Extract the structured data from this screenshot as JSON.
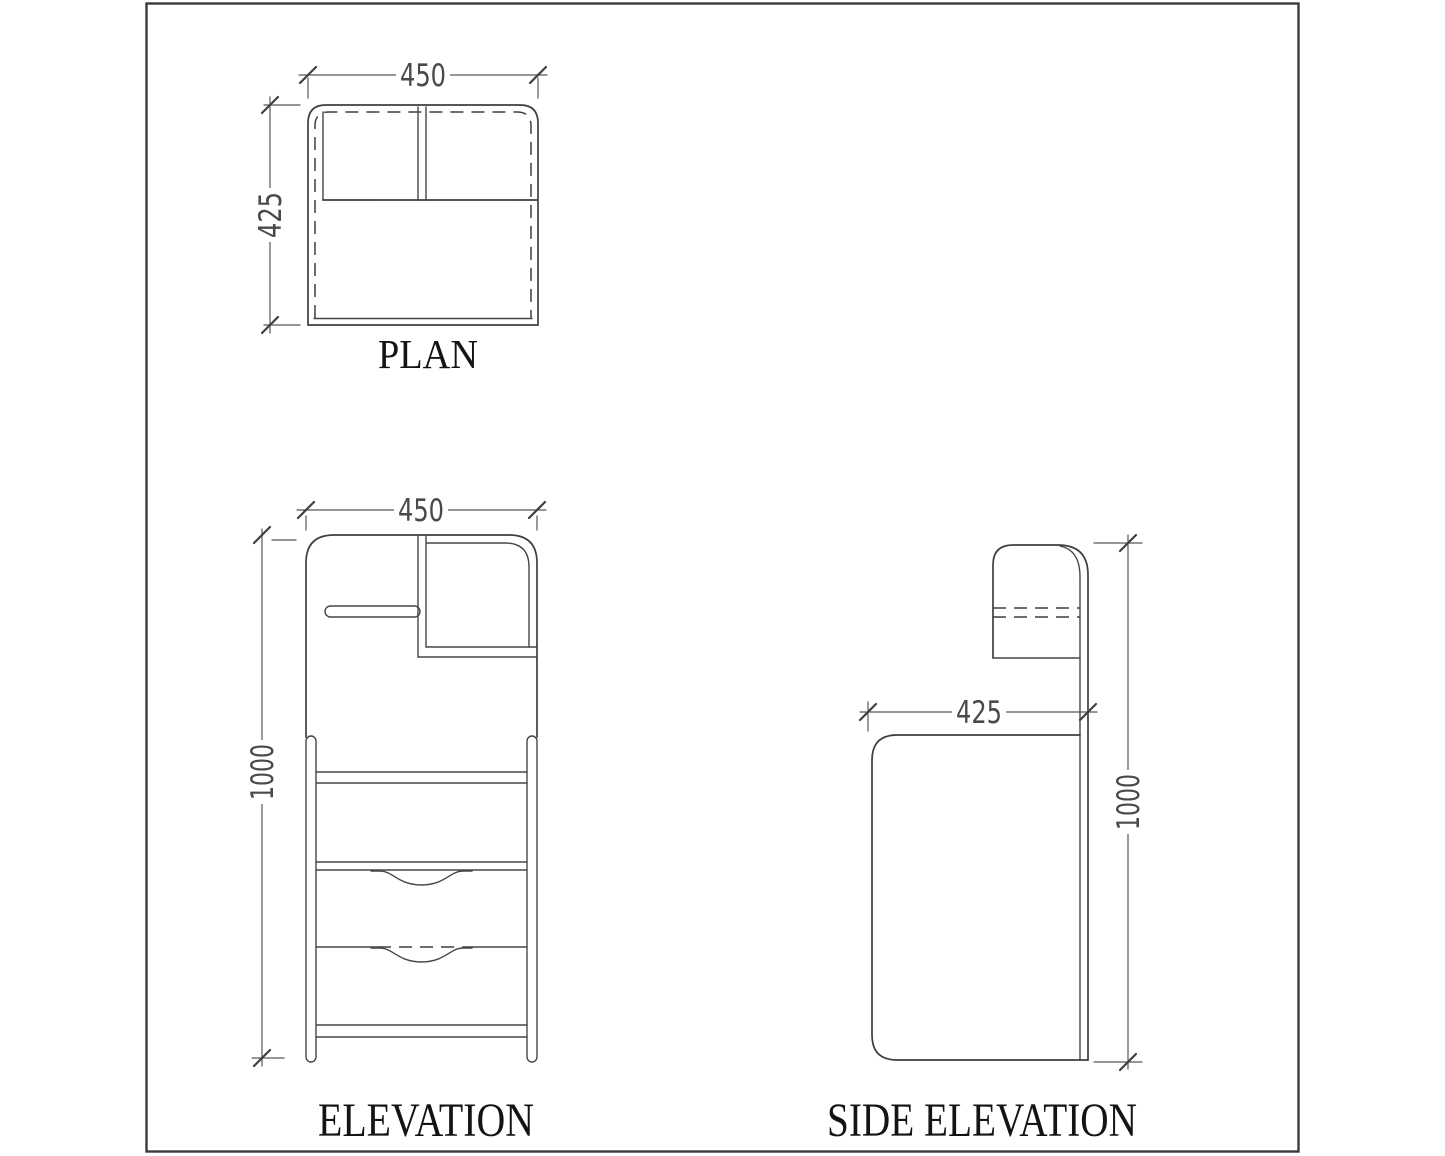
{
  "drawing": {
    "plan": {
      "label": "PLAN",
      "width_dim": "450",
      "depth_dim": "425"
    },
    "elevation": {
      "label": "ELEVATION",
      "width_dim": "450",
      "height_dim": "1000"
    },
    "side_elevation": {
      "label": "SIDE ELEVATION",
      "depth_dim": "425",
      "height_dim": "1000"
    }
  },
  "colors": {
    "object_line": "#3f3f3f",
    "dimension_line": "#575757",
    "dimension_text": "#4a4a4a",
    "label_text": "#141414",
    "frame": "#3a3a3a",
    "background": "#ffffff"
  }
}
